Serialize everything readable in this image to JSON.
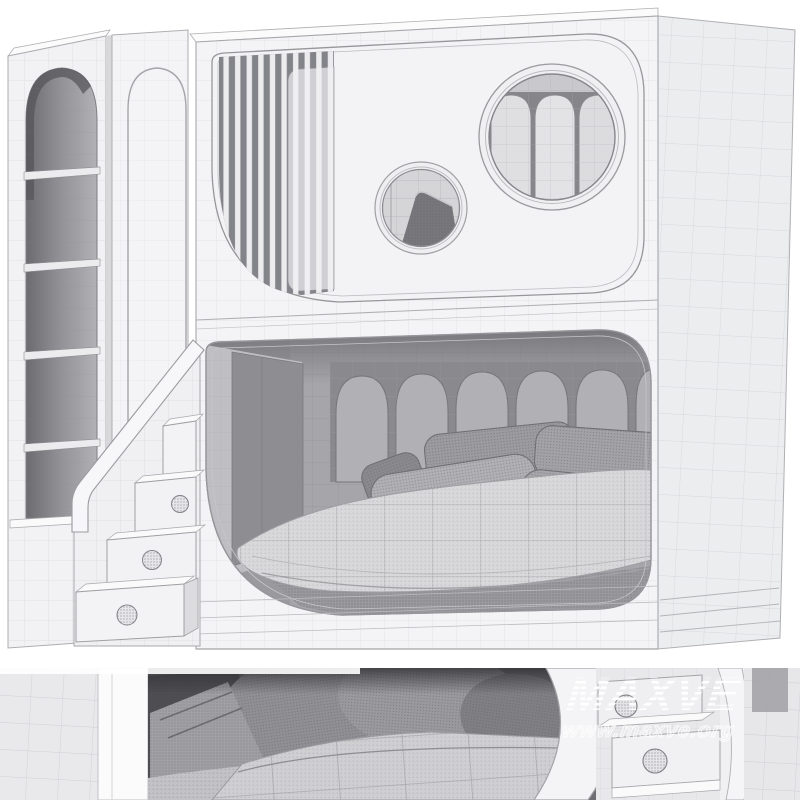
{
  "watermark": {
    "brand": "MAXVE",
    "url": "www.maxve.org"
  },
  "colors": {
    "background": "#ffffff",
    "surface_front": "#f4f4f6",
    "surface_side": "#ecedef",
    "wireframe_line": "#c8c8cd",
    "interior_dark": "#8e8e92",
    "interior_wall": "#a6a6aa",
    "fabric_pillow": "#a4a4a8",
    "fabric_quilt": "#d7d7d9",
    "watermark_color": "#ffffff"
  },
  "render": {
    "subject": "wireframe 3D render of a kids bunk bed with bookshelf, wardrobe panel, porthole windows, scalloped headboards and stair drawers",
    "views": [
      "full model",
      "bedding close-up"
    ]
  }
}
